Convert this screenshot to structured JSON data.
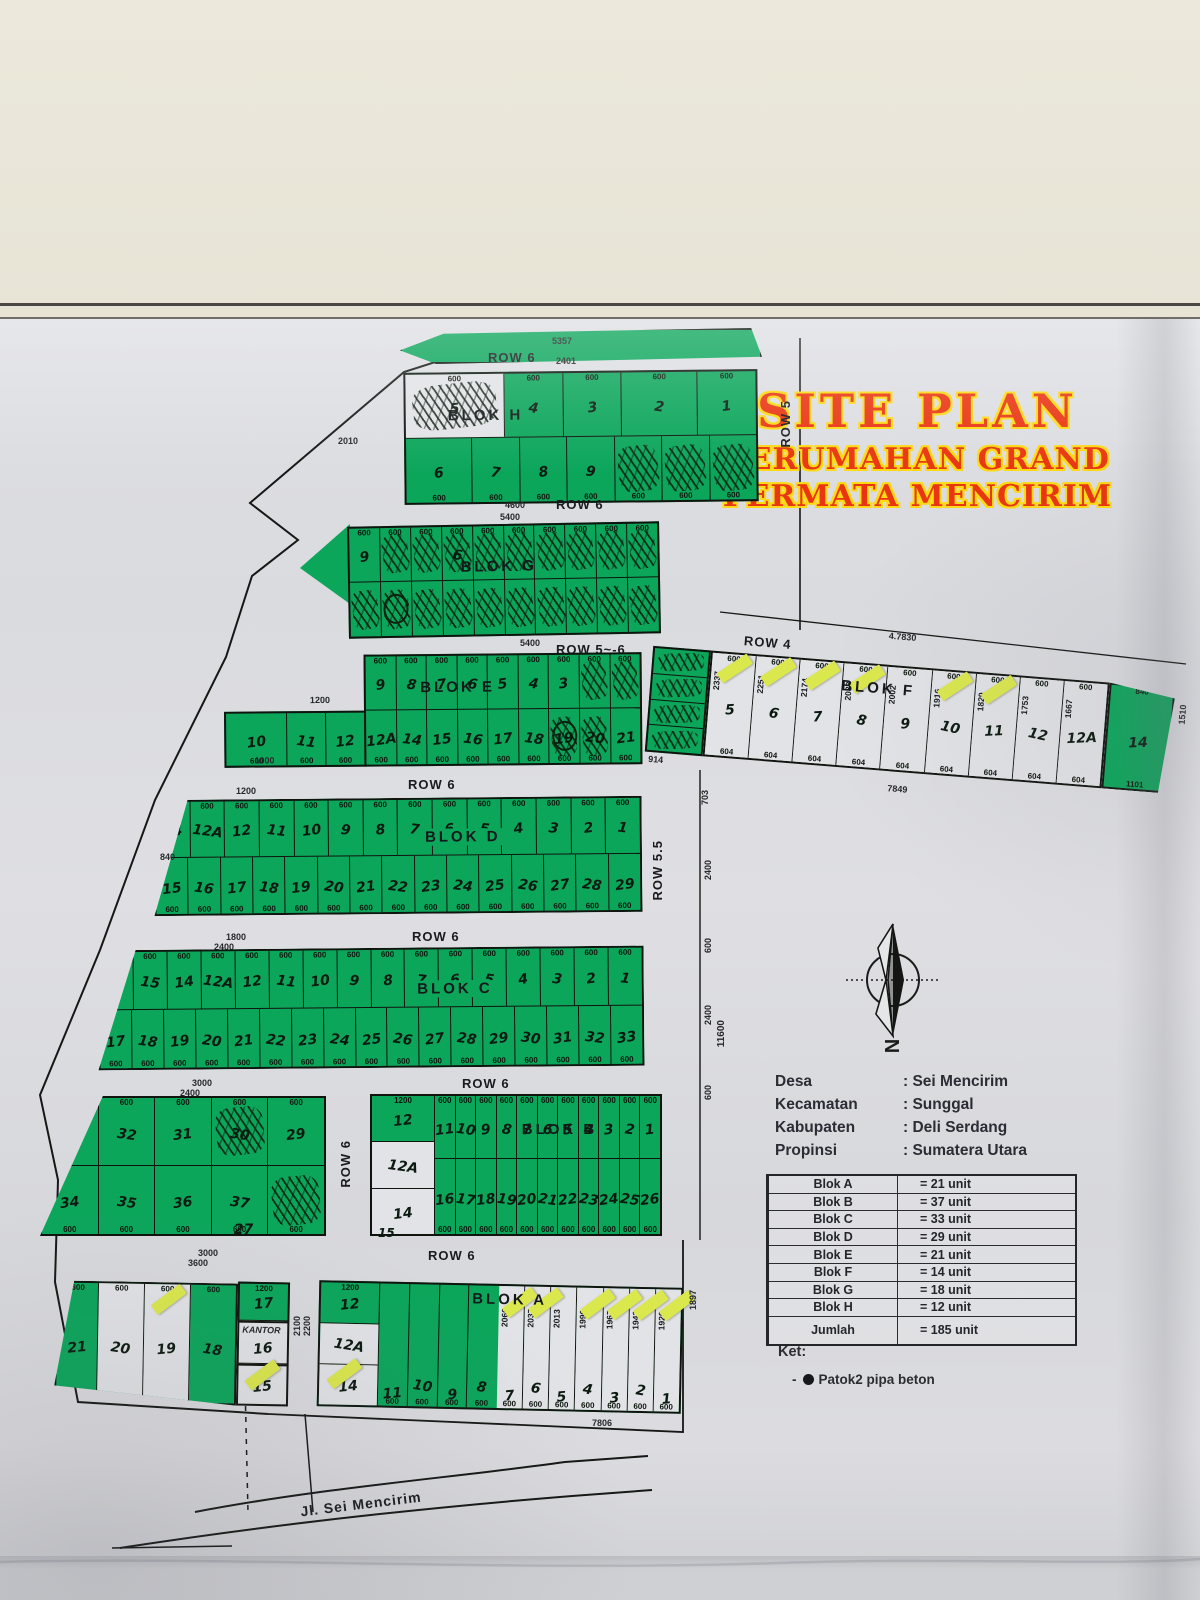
{
  "title": {
    "line1": "SITE PLAN",
    "line2": "PERUMAHAN GRAND",
    "line3": "PERMATA MENCIRIM"
  },
  "rows": {
    "row6": "ROW 6",
    "row56": "ROW 5~-6",
    "row5": "ROW 5",
    "row55": "ROW 5.5",
    "row4": "ROW 4"
  },
  "dims": {
    "d5357": "5357",
    "d2401": "2401",
    "d4600": "4600",
    "d5400": "5400",
    "d1100": "1100",
    "d2010": "2010",
    "d810": "810",
    "d1200": "1200",
    "d1800": "1800",
    "d2400": "2400",
    "d3000": "3000",
    "d3600": "3600",
    "d7830": "4.7830",
    "d7849": "7849",
    "d7806": "7806",
    "d11600": "11600",
    "d703": "703",
    "d600": "600",
    "d1897": "1897",
    "d2100": "2100",
    "d2200": "2200",
    "d1510": "1510",
    "d914": "914",
    "d840": "840",
    "d1101": "1101",
    "d1000": "1000",
    "d27": "27",
    "d15": "15",
    "d700": "700"
  },
  "blocks": {
    "H": {
      "label": "BLOK H",
      "row1": {
        "dim": "600",
        "cells": [
          {
            "n": "5",
            "w": 1,
            "f": 1.7,
            "s": 1
          },
          {
            "n": "4"
          },
          {
            "n": "3"
          },
          {
            "n": "2",
            "f": 1.3
          },
          {
            "n": "1"
          }
        ]
      },
      "row2": {
        "dim": "600",
        "dp": "b",
        "cells": [
          {
            "n": "6",
            "f": 1.4
          },
          {
            "n": "7"
          },
          {
            "n": "8"
          },
          {
            "n": "9"
          },
          {
            "s": 1
          },
          {
            "s": 1
          },
          {
            "s": 1
          }
        ]
      }
    },
    "G": {
      "label": "BLOK G",
      "row1": {
        "dim": "600",
        "cells": [
          {
            "n": "9"
          },
          {
            "s": 1
          },
          {
            "s": 1
          },
          {
            "n": "6",
            "s": 1
          },
          {
            "s": 1
          },
          {
            "s": 1
          },
          {
            "s": 1
          },
          {
            "s": 1
          },
          {
            "s": 1
          },
          {
            "s": 1
          }
        ]
      },
      "row2": {
        "cells": [
          {
            "s": 1
          },
          {
            "s": 1,
            "c": 1
          },
          {
            "s": 1
          },
          {
            "s": 1
          },
          {
            "s": 1
          },
          {
            "s": 1
          },
          {
            "s": 1
          },
          {
            "s": 1
          },
          {
            "s": 1
          },
          {
            "s": 1
          }
        ]
      }
    },
    "E": {
      "label": "BLOK E",
      "row1": {
        "dim": "600",
        "cells": [
          {
            "n": "9"
          },
          {
            "n": "8"
          },
          {
            "n": "7"
          },
          {
            "n": "6"
          },
          {
            "n": "5"
          },
          {
            "n": "4"
          },
          {
            "n": "3"
          },
          {
            "s": 1
          },
          {
            "s": 1
          }
        ]
      },
      "row2": {
        "dim": "600",
        "dp": "b",
        "cells": [
          {
            "n": "12A"
          },
          {
            "n": "14"
          },
          {
            "n": "15"
          },
          {
            "n": "16"
          },
          {
            "n": "17"
          },
          {
            "n": "18"
          },
          {
            "n": "19",
            "s": 1,
            "c": 1
          },
          {
            "n": "20",
            "s": 1
          },
          {
            "n": "21"
          }
        ]
      },
      "left": {
        "dim": "600",
        "dp": "b",
        "cells": [
          {
            "n": "10",
            "f": 1.6
          },
          {
            "n": "11"
          },
          {
            "n": "12"
          }
        ]
      }
    },
    "D": {
      "label": "BLOK D",
      "row1": {
        "dim": "600",
        "cells": [
          {
            "n": "14"
          },
          {
            "n": "12A"
          },
          {
            "n": "12"
          },
          {
            "n": "11"
          },
          {
            "n": "10"
          },
          {
            "n": "9"
          },
          {
            "n": "8"
          },
          {
            "n": "7"
          },
          {
            "n": "6"
          },
          {
            "n": "5"
          },
          {
            "n": "4"
          },
          {
            "n": "3"
          },
          {
            "n": "2"
          },
          {
            "n": "1"
          }
        ]
      },
      "row2": {
        "dim": "600",
        "dp": "b",
        "cells": [
          {
            "n": "15"
          },
          {
            "n": "16"
          },
          {
            "n": "17"
          },
          {
            "n": "18"
          },
          {
            "n": "19"
          },
          {
            "n": "20"
          },
          {
            "n": "21"
          },
          {
            "n": "22"
          },
          {
            "n": "23"
          },
          {
            "n": "24"
          },
          {
            "n": "25"
          },
          {
            "n": "26"
          },
          {
            "n": "27"
          },
          {
            "n": "28"
          },
          {
            "n": "29"
          }
        ]
      }
    },
    "C": {
      "label": "BLOK C",
      "row1": {
        "dim": "600",
        "cells": [
          {
            "n": "16"
          },
          {
            "n": "15"
          },
          {
            "n": "14"
          },
          {
            "n": "12A"
          },
          {
            "n": "12"
          },
          {
            "n": "11"
          },
          {
            "n": "10"
          },
          {
            "n": "9"
          },
          {
            "n": "8"
          },
          {
            "n": "7"
          },
          {
            "n": "6"
          },
          {
            "n": "5"
          },
          {
            "n": "4"
          },
          {
            "n": "3"
          },
          {
            "n": "2"
          },
          {
            "n": "1"
          }
        ]
      },
      "row2": {
        "dim": "600",
        "dp": "b",
        "cells": [
          {
            "n": "17"
          },
          {
            "n": "18"
          },
          {
            "n": "19"
          },
          {
            "n": "20"
          },
          {
            "n": "21"
          },
          {
            "n": "22"
          },
          {
            "n": "23"
          },
          {
            "n": "24"
          },
          {
            "n": "25"
          },
          {
            "n": "26"
          },
          {
            "n": "27"
          },
          {
            "n": "28"
          },
          {
            "n": "29"
          },
          {
            "n": "30"
          },
          {
            "n": "31"
          },
          {
            "n": "32"
          },
          {
            "n": "33"
          }
        ]
      }
    },
    "B": {
      "label": "BLOK B",
      "n15": "15",
      "annex1": {
        "dim": "600",
        "cells": [
          {
            "n": "33"
          },
          {
            "n": "32"
          },
          {
            "n": "31"
          },
          {
            "n": "30",
            "s": 1
          },
          {
            "n": "29"
          }
        ]
      },
      "annex2": {
        "dim": "600",
        "dp": "b",
        "cells": [
          {
            "n": "34"
          },
          {
            "n": "35"
          },
          {
            "n": "36"
          },
          {
            "n": "37"
          },
          {
            "s": 1
          }
        ]
      },
      "col": [
        {
          "n": "12",
          "t": "1200"
        },
        {
          "n": "12A",
          "w": 1
        },
        {
          "n": "14",
          "w": 1
        }
      ],
      "row1": {
        "dim": "600",
        "cells": [
          {
            "n": "11"
          },
          {
            "n": "10"
          },
          {
            "n": "9"
          },
          {
            "n": "8"
          },
          {
            "n": "7"
          },
          {
            "n": "6"
          },
          {
            "n": "5"
          },
          {
            "n": "4"
          },
          {
            "n": "3"
          },
          {
            "n": "2"
          },
          {
            "n": "1"
          }
        ]
      },
      "row2": {
        "dim": "600",
        "dp": "b",
        "cells": [
          {
            "n": "16"
          },
          {
            "n": "17"
          },
          {
            "n": "18"
          },
          {
            "n": "19"
          },
          {
            "n": "20"
          },
          {
            "n": "21"
          },
          {
            "n": "22"
          },
          {
            "n": "23"
          },
          {
            "n": "24"
          },
          {
            "n": "25"
          },
          {
            "n": "26"
          }
        ]
      }
    },
    "A": {
      "label": "BLOK A",
      "kantor": "KANTOR",
      "c17": "17",
      "c16": "16",
      "c15": "15",
      "left": {
        "dim": "600",
        "cells": [
          {
            "n": "21",
            "f": 0.9
          },
          {
            "n": "20",
            "w": 1
          },
          {
            "n": "19",
            "w": 1,
            "y": 1
          },
          {
            "n": "18"
          }
        ]
      },
      "col": [
        {
          "n": "12",
          "t": "1200"
        },
        {
          "n": "12A",
          "w": 1
        },
        {
          "n": "14",
          "w": 1,
          "y": 1
        }
      ],
      "green": {
        "dim": "600",
        "dp": "b",
        "cells": [
          {
            "n": "11"
          },
          {
            "n": "10"
          },
          {
            "n": "9"
          },
          {
            "n": "8"
          }
        ]
      },
      "whites": {
        "dim": "600",
        "dp": "b",
        "cells": [
          {
            "n": "7",
            "w": 1,
            "y": 1,
            "d": "2060"
          },
          {
            "n": "6",
            "w": 1,
            "y": 1,
            "d": "2037"
          },
          {
            "n": "5",
            "w": 1,
            "d": "2013"
          },
          {
            "n": "4",
            "w": 1,
            "y": 1,
            "d": "1990"
          },
          {
            "n": "3",
            "w": 1,
            "y": 1,
            "d": "1967"
          },
          {
            "n": "2",
            "w": 1,
            "y": 1,
            "d": "1943"
          },
          {
            "n": "1",
            "w": 1,
            "y": 1,
            "d": "1920"
          }
        ]
      }
    },
    "F": {
      "label": "BLOK F",
      "scrcol": [
        {
          "s": 1
        },
        {
          "s": 1
        },
        {
          "s": 1
        },
        {
          "s": 1
        }
      ],
      "cells": {
        "dim": "600",
        "dimb": "604",
        "cells": [
          {
            "n": "5",
            "w": 1,
            "y": 1,
            "d": "2337"
          },
          {
            "n": "6",
            "w": 1,
            "y": 1,
            "d": "2251"
          },
          {
            "n": "7",
            "w": 1,
            "y": 1,
            "d": "2174"
          },
          {
            "n": "8",
            "w": 1,
            "y": 1,
            "d": "2088"
          },
          {
            "n": "9",
            "w": 1,
            "d": "2002"
          },
          {
            "n": "10",
            "w": 1,
            "y": 1,
            "d": "1916"
          },
          {
            "n": "11",
            "w": 1,
            "y": 1,
            "d": "1829"
          },
          {
            "n": "12",
            "w": 1,
            "d": "1753"
          },
          {
            "n": "12A",
            "w": 1,
            "d": "1667"
          }
        ]
      },
      "end": {
        "n": "14"
      }
    }
  },
  "info": {
    "rows": [
      {
        "label": "Desa",
        "value": ": Sei Mencirim"
      },
      {
        "label": "Kecamatan",
        "value": ": Sunggal"
      },
      {
        "label": "Kabupaten",
        "value": ": Deli Serdang"
      },
      {
        "label": "Propinsi",
        "value": ": Sumatera Utara"
      }
    ]
  },
  "legend_table": {
    "rows": [
      {
        "blok": "Blok A",
        "units": "= 21 unit"
      },
      {
        "blok": "Blok B",
        "units": "= 37 unit"
      },
      {
        "blok": "Blok C",
        "units": "= 33 unit"
      },
      {
        "blok": "Blok D",
        "units": "= 29 unit"
      },
      {
        "blok": "Blok E",
        "units": "= 21 unit"
      },
      {
        "blok": "Blok F",
        "units": "= 14 unit"
      },
      {
        "blok": "Blok G",
        "units": "= 18 unit"
      },
      {
        "blok": "Blok H",
        "units": "= 12 unit"
      },
      {
        "blok": "Jumlah",
        "units": "= 185 unit"
      }
    ]
  },
  "ket": {
    "title": "Ket:",
    "dash": "-",
    "item": "Patok2 pipa beton"
  },
  "compass": {
    "n": "N"
  },
  "road_name": "Jl. Sei Mencirim",
  "colors": {
    "green": "#0ca65b",
    "title_red": "#e93512",
    "title_outline": "#ffd913",
    "sticky": "#dbe84d"
  }
}
